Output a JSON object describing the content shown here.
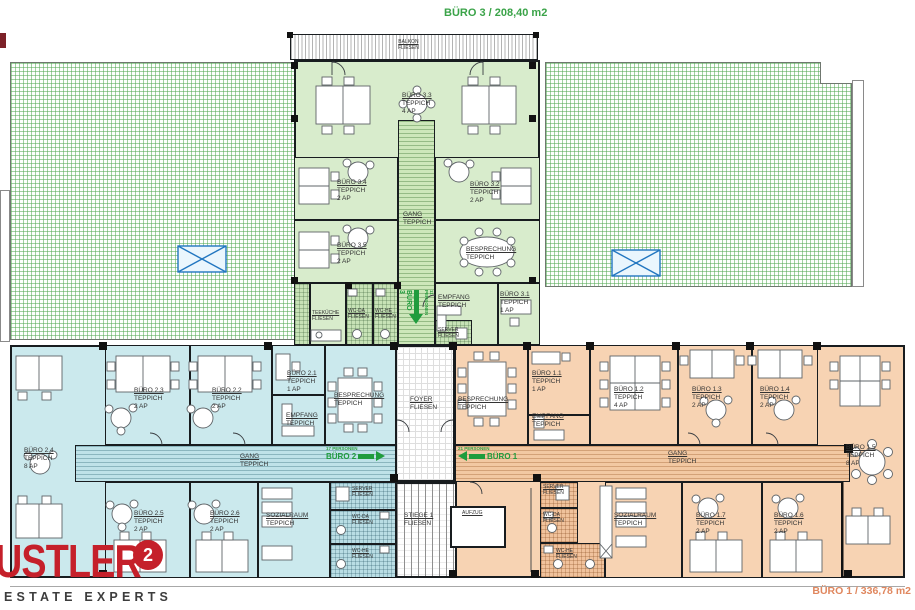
{
  "titles": {
    "buero3": "BÜRO 3 / 208,40 m2",
    "buero1": "BÜRO 1 / 336,78 m2"
  },
  "logo": {
    "wordmark": "USTLER",
    "sup": "2",
    "tagline": "ESTATE EXPERTS"
  },
  "entrances": {
    "b3": {
      "label": "BÜRO 3",
      "persons": "11 PERSONEN"
    },
    "b2": {
      "label": "BÜRO 2",
      "persons": "17 PERSONEN"
    },
    "b1": {
      "label": "BÜRO 1",
      "persons": "21 PERSONEN"
    }
  },
  "rooms": {
    "balkon": {
      "name": "BALKON",
      "floor": "FLIESEN"
    },
    "gang3": {
      "name": "GANG",
      "floor": "TEPPICH"
    },
    "b33": {
      "name": "BÜRO 3.3",
      "floor": "TEPPICH",
      "cap": "4 AP"
    },
    "b34": {
      "name": "BÜRO 3.4",
      "floor": "TEPPICH",
      "cap": "2 AP"
    },
    "b32": {
      "name": "BÜRO 3.2",
      "floor": "TEPPICH",
      "cap": "2 AP"
    },
    "b35": {
      "name": "BÜRO 3.5",
      "floor": "TEPPICH",
      "cap": "2 AP"
    },
    "bespr3": {
      "name": "BESPRECHUNG",
      "floor": "TEPPICH"
    },
    "empf3": {
      "name": "EMPFANG",
      "floor": "TEPPICH"
    },
    "b31": {
      "name": "BÜRO 3.1",
      "floor": "TEPPICH",
      "cap": "1 AP"
    },
    "teek3": {
      "name": "TEEKÜCHE",
      "floor": "FLIESEN"
    },
    "wcda3": {
      "name": "WC-DA",
      "floor": "FLIESEN"
    },
    "wche3": {
      "name": "WC-HE",
      "floor": "FLIESEN"
    },
    "server3": {
      "name": "SERVER",
      "floor": "FLIESEN"
    },
    "b23": {
      "name": "BÜRO 2.3",
      "floor": "TEPPICH",
      "cap": "2 AP"
    },
    "b22": {
      "name": "BÜRO 2.2",
      "floor": "TEPPICH",
      "cap": "2 AP"
    },
    "b21": {
      "name": "BÜRO 2.1",
      "floor": "TEPPICH",
      "cap": "1 AP"
    },
    "empf2": {
      "name": "EMPFANG",
      "floor": "TEPPICH"
    },
    "bespr2": {
      "name": "BESPRECHUNG",
      "floor": "TEPPICH"
    },
    "b24": {
      "name": "BÜRO 2.4",
      "floor": "TEPPICH",
      "cap": "8 AP"
    },
    "gang2": {
      "name": "GANG",
      "floor": "TEPPICH"
    },
    "b25": {
      "name": "BÜRO 2.5",
      "floor": "TEPPICH",
      "cap": "2 AP"
    },
    "b26": {
      "name": "BÜRO 2.6",
      "floor": "TEPPICH",
      "cap": "2 AP"
    },
    "soz2": {
      "name": "SOZIALRAUM",
      "floor": "TEPPICH"
    },
    "server2": {
      "name": "SERVER",
      "floor": "FLIESEN"
    },
    "wcda2": {
      "name": "WC-DA",
      "floor": "FLIESEN"
    },
    "wche2": {
      "name": "WC-HE",
      "floor": "FLIESEN"
    },
    "foyer": {
      "name": "FOYER",
      "floor": "FLIESEN"
    },
    "stiege": {
      "name": "STIEGE 1",
      "floor": "FLIESEN"
    },
    "aufzug": {
      "name": "AUFZUG"
    },
    "bespr1": {
      "name": "BESPRECHUNG",
      "floor": "TEPPICH"
    },
    "b11": {
      "name": "BÜRO 1.1",
      "floor": "TEPPICH",
      "cap": "1 AP"
    },
    "empf1": {
      "name": "EMPFANG",
      "floor": "TEPPICH"
    },
    "b12": {
      "name": "BÜRO 1.2",
      "floor": "TEPPICH",
      "cap": "4 AP"
    },
    "b13": {
      "name": "BÜRO 1.3",
      "floor": "TEPPICH",
      "cap": "2 AP"
    },
    "b14": {
      "name": "BÜRO 1.4",
      "floor": "TEPPICH",
      "cap": "2 AP"
    },
    "b15": {
      "name": "BÜRO 1.5",
      "floor": "TEPPICH",
      "cap": "8 AP"
    },
    "gang1": {
      "name": "GANG",
      "floor": "TEPPICH"
    },
    "server1": {
      "name": "SERVER",
      "floor": "FLIESEN"
    },
    "wcda1": {
      "name": "WC-DA",
      "floor": "FLIESEN"
    },
    "wche1": {
      "name": "WC-HE",
      "floor": "FLIESEN"
    },
    "soz1": {
      "name": "SOZIALRAUM",
      "floor": "TEPPICH"
    },
    "b17": {
      "name": "BÜRO 1.7",
      "floor": "TEPPICH",
      "cap": "2 AP"
    },
    "b16": {
      "name": "BÜRO 1.6",
      "floor": "TEPPICH",
      "cap": "2 AP"
    }
  }
}
